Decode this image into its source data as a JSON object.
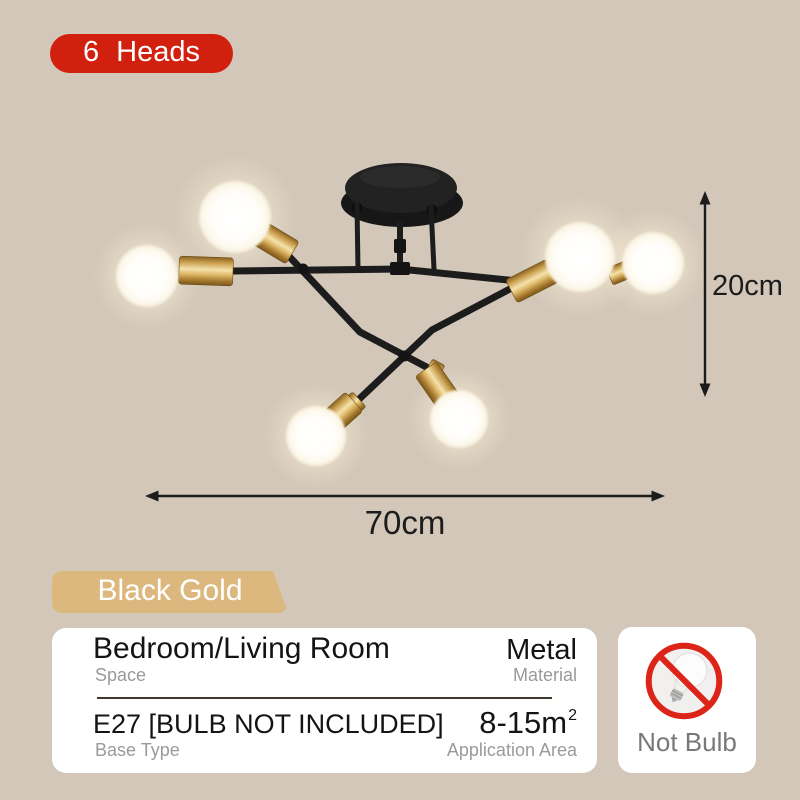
{
  "page": {
    "background_color": "#d2c7b9"
  },
  "heads_badge": {
    "label": "6 Heads",
    "color": "#d2200f"
  },
  "product": {
    "name": "6-head ceiling lamp",
    "finish": {
      "metal_color": "#1d1d1d",
      "socket_gold_color": "#c89a46",
      "bulb_color": "#ffffff"
    },
    "dimensions": {
      "height": "20cm",
      "width": "70cm"
    }
  },
  "variant_badge": {
    "label": "Black Gold",
    "color": "#dcb87e"
  },
  "spec_card": {
    "rows": [
      {
        "left": {
          "value": "Bedroom/Living Room",
          "label": "Space"
        },
        "right": {
          "value": "Metal",
          "label": "Material"
        }
      },
      {
        "left": {
          "value": "E27 [BULB NOT INCLUDED]",
          "label": "Base Type"
        },
        "right": {
          "value": "8-15m",
          "value_sup": "2",
          "label": "Application Area"
        }
      }
    ]
  },
  "not_bulb_card": {
    "label": "Not Bulb",
    "icon": "no-bulb-icon",
    "prohibit_color": "#dd2418"
  }
}
